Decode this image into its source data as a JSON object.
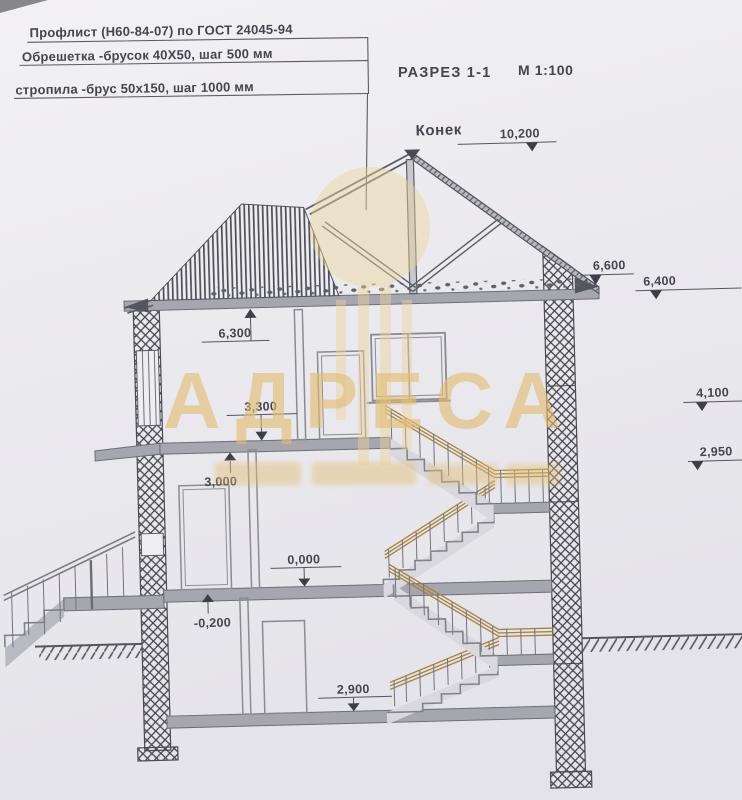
{
  "drawing": {
    "notes": {
      "line1": "Профлист (Н60-84-07) по ГОСТ 24045-94",
      "line2": "Обрешетка -брусок 40Х50, шаг 500 мм",
      "line3": "стропила -брус 50х150, шаг 1000 мм"
    },
    "title": "РАЗРЕЗ 1-1",
    "scale": "М 1:100",
    "ridge_label": "Конек",
    "levels": {
      "ridge": "10,200",
      "eave_inner": "6,600",
      "eave_outer": "6,400",
      "attic_floor": "6,300",
      "right_upper": "4,100",
      "second_floor": "3,300",
      "first_floor_height": "3,000",
      "right_lower": "2,950",
      "zero": "0,000",
      "entrance": "-0,200",
      "basement": "2,900"
    },
    "watermark": {
      "text": "АДРЕСА",
      "color": "#e3bd72"
    },
    "colors": {
      "paper": "#eeedf2",
      "ink": "#55555e",
      "slab": "#a6a6af",
      "stair_fill": "#d9d8de",
      "rail": "#a5823f",
      "watermark": "#e3bd72"
    }
  }
}
